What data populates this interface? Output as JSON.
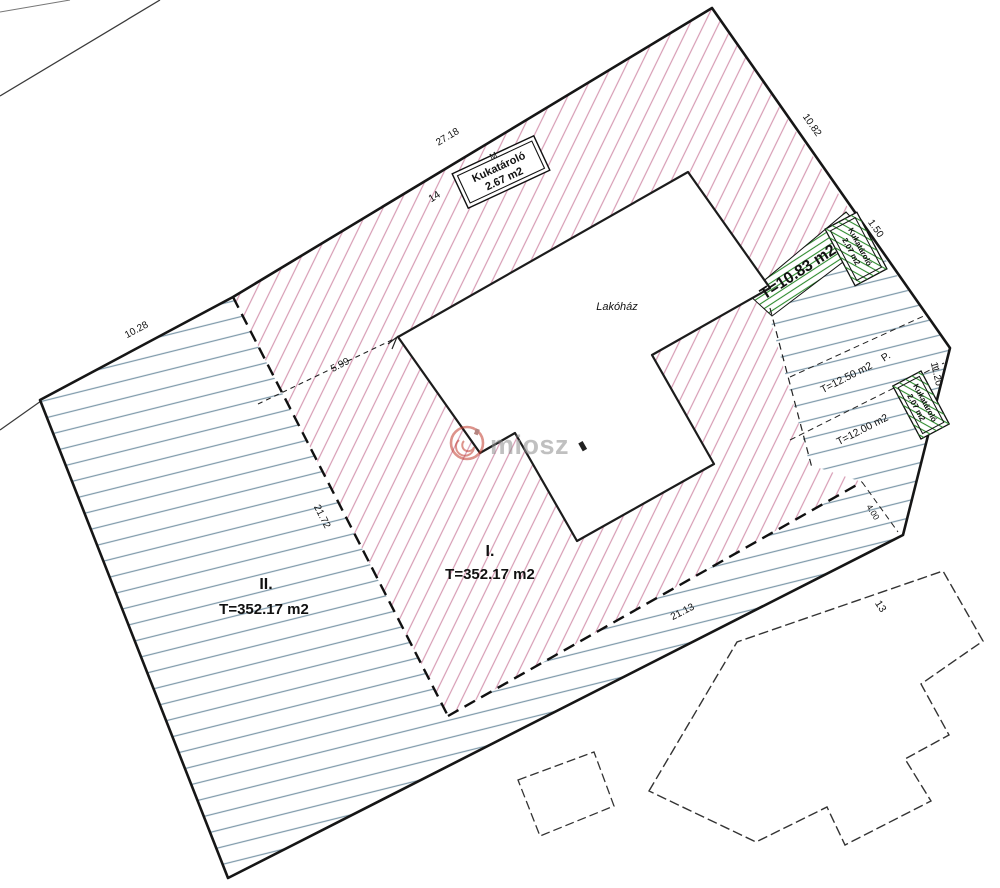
{
  "drawing": {
    "watermark": "miosz",
    "building_label": "Lakóház",
    "areas": {
      "zone1_roman": "I.",
      "zone1_area": "T=352.17 m2",
      "zone2_roman": "II.",
      "zone2_area": "T=352.17 m2",
      "green_strip_area": "T=10.83 m2",
      "east_upper_area": "T=12.50 m2",
      "east_lower_area": "T=12.00 m2",
      "parking_label": "P."
    },
    "storage_boxes": {
      "top": {
        "name": "Kukatároló",
        "area": "2.67 m2"
      },
      "right": {
        "name": "Kukatároló",
        "area": "2.07 m2"
      },
      "east": {
        "name": "Kukatároló",
        "area": "2.07 m2"
      }
    },
    "dimensions": {
      "top_edge": "27.18",
      "upper_right_edge": "10.82",
      "right_box_width": "1.50",
      "right_edge": "11.20",
      "upper_left_edge": "10.28",
      "building_setback": "5.99",
      "west_split": "21.72",
      "south_split": "21.13",
      "south_east": "4.00"
    },
    "parcel_numbers": {
      "main": "14",
      "neighbor": "13",
      "north_mark": "M"
    },
    "colors": {
      "pink_hatch": "#d79cb4",
      "blue_hatch": "#7f9aab",
      "green": "#2e8b2e",
      "logo_red": "#c23b2e",
      "watermark_gray": "#8e8e8e"
    }
  }
}
